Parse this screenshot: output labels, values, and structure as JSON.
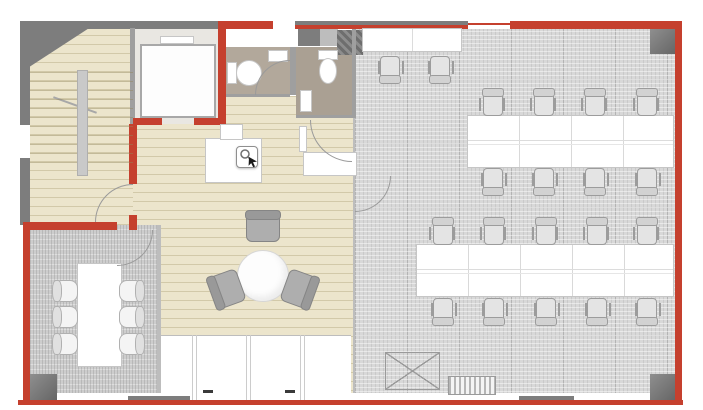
{
  "meta": {
    "title": "office-floor-plan",
    "description": "architectural floor plan drawing, no visible text labels",
    "cursor_overlay": "zoom-magnifier-cursor"
  },
  "palette": {
    "boundary_red": "#c5402e",
    "structural_wall_gray": "#7d7d7d",
    "partition_gray": "#9f9f9f",
    "wood_floor": "#ece5cc",
    "carpet_gray": "#d8d8d8",
    "meeting_carpet": "#cdcdcd",
    "bathroom_floor": "#b2a89b",
    "furniture_white": "#ffffff",
    "chair_gray": "#e4e4e4",
    "armchair_gray": "#aeaeae"
  },
  "legend": {
    "rooms": [
      "stairwell",
      "elevator",
      "wc-1",
      "wc-2",
      "entrance-hall",
      "kitchenette",
      "lounge",
      "meeting-room",
      "open-office",
      "vestibule"
    ],
    "counts": {
      "open_office_chairs": 20,
      "bench_desk_rows": 2,
      "wall_desks": 2,
      "meeting_room_chairs": 6,
      "lounge_armchairs": 3,
      "toilets": 2,
      "sinks": 2
    }
  },
  "stairs": {
    "x": 30,
    "y": 72,
    "w": 103,
    "count": 11,
    "step": 9
  },
  "vestibule_mullions": [
    192,
    196,
    246,
    250,
    300,
    304
  ],
  "door_markers": [
    {
      "x": 203,
      "y": 390
    },
    {
      "x": 285,
      "y": 390
    }
  ],
  "elements": [
    {
      "n": "stair-hall-floor",
      "c": "wood",
      "x": 30,
      "y": 28,
      "w": 103,
      "h": 197
    },
    {
      "n": "elevator-lobby-floor",
      "c": "lobbyf",
      "x": 133,
      "y": 28,
      "w": 85,
      "h": 96
    },
    {
      "n": "hall-floor-upper",
      "c": "wood",
      "x": 222,
      "y": 96,
      "w": 133,
      "h": 28
    },
    {
      "n": "hall-floor-main",
      "c": "wood",
      "x": 133,
      "y": 124,
      "w": 222,
      "h": 276
    },
    {
      "n": "office-floor",
      "c": "carpet",
      "x": 355,
      "y": 21,
      "w": 321,
      "h": 379
    },
    {
      "n": "meeting-room-floor",
      "c": "carpet2",
      "x": 30,
      "y": 225,
      "w": 131,
      "h": 175
    },
    {
      "n": "bath-1-floor",
      "c": "bathf",
      "x": 226,
      "y": 47,
      "w": 64,
      "h": 49
    },
    {
      "n": "bath-2-floor",
      "c": "bathf2",
      "x": 296,
      "y": 47,
      "w": 58,
      "h": 71
    },
    {
      "n": "vestibule-floor",
      "c": "window",
      "x": 161,
      "y": 335,
      "w": 190,
      "h": 65
    },
    {
      "n": "vestibule-top-line",
      "c": "thinline",
      "x": 161,
      "y": 335,
      "w": 190,
      "h": 1
    },
    {
      "n": "stair-stringer",
      "c": "stringer",
      "x": 77,
      "y": 70,
      "w": 11,
      "h": 106
    },
    {
      "n": "stair-direction-line",
      "c": "thinline2",
      "x": 52,
      "y": 104,
      "w": 46,
      "h": 2,
      "r": 20
    },
    {
      "n": "top-wall-left",
      "c": "wall",
      "x": 20,
      "y": 21,
      "w": 198,
      "h": 8
    },
    {
      "n": "top-left-chamfer-wall",
      "c": "tri",
      "x": 20,
      "y": 21,
      "w": 80,
      "h": 52
    },
    {
      "n": "left-wall-upper",
      "c": "wall",
      "x": 20,
      "y": 21,
      "w": 10,
      "h": 204
    },
    {
      "n": "left-wall-window",
      "c": "window",
      "x": 20,
      "y": 125,
      "w": 10,
      "h": 33
    },
    {
      "n": "top-wall-mid-gray",
      "c": "wall",
      "x": 295,
      "y": 21,
      "w": 173,
      "h": 5
    },
    {
      "n": "shaft-block",
      "c": "wall",
      "x": 298,
      "y": 27,
      "w": 22,
      "h": 19
    },
    {
      "n": "shaft-block-light",
      "c": "ltpart",
      "x": 320,
      "y": 29,
      "w": 18,
      "h": 17
    },
    {
      "n": "hatched-column",
      "c": "hatchcol",
      "x": 337,
      "y": 30,
      "w": 26,
      "h": 25
    },
    {
      "n": "corner-column-tr",
      "c": "wallD",
      "x": 650,
      "y": 29,
      "w": 26,
      "h": 25
    },
    {
      "n": "corner-column-br",
      "c": "wallD",
      "x": 650,
      "y": 374,
      "w": 26,
      "h": 26
    },
    {
      "n": "corner-column-bl",
      "c": "wallD",
      "x": 30,
      "y": 374,
      "w": 27,
      "h": 26
    },
    {
      "n": "stair-lobby-wall",
      "c": "partition",
      "x": 130,
      "y": 28,
      "w": 5,
      "h": 96
    },
    {
      "n": "bath-divider-wall",
      "c": "partition",
      "x": 290,
      "y": 47,
      "w": 6,
      "h": 48
    },
    {
      "n": "bath-1-bottom-wall",
      "c": "partition",
      "x": 222,
      "y": 94,
      "w": 68,
      "h": 3
    },
    {
      "n": "bath-2-bottom-wall",
      "c": "partition",
      "x": 296,
      "y": 115,
      "w": 58,
      "h": 3
    },
    {
      "n": "bath-office-wall",
      "c": "partition",
      "x": 352,
      "y": 28,
      "w": 4,
      "h": 90
    },
    {
      "n": "hall-office-boundary",
      "c": "thinline",
      "x": 353,
      "y": 118,
      "w": 2,
      "h": 282
    },
    {
      "n": "meeting-room-right-wall",
      "c": "ltpart",
      "x": 157,
      "y": 225,
      "w": 4,
      "h": 175
    },
    {
      "n": "top-wall-red-a",
      "c": "red",
      "x": 218,
      "y": 21,
      "w": 55,
      "h": 8
    },
    {
      "n": "top-window-gap-a",
      "c": "window",
      "x": 273,
      "y": 21,
      "w": 22,
      "h": 8
    },
    {
      "n": "top-wall-red-b",
      "c": "red",
      "x": 295,
      "y": 25,
      "w": 173,
      "h": 4
    },
    {
      "n": "top-window-gap-b",
      "c": "window",
      "x": 468,
      "y": 21,
      "w": 42,
      "h": 8
    },
    {
      "n": "top-window-red-line",
      "c": "red",
      "x": 468,
      "y": 23,
      "w": 42,
      "h": 2
    },
    {
      "n": "top-wall-red-c",
      "c": "red",
      "x": 510,
      "y": 21,
      "w": 170,
      "h": 8
    },
    {
      "n": "right-wall-red",
      "c": "red",
      "x": 675,
      "y": 21,
      "w": 7,
      "h": 384
    },
    {
      "n": "elevator-right-wall-red",
      "c": "red",
      "x": 218,
      "y": 28,
      "w": 8,
      "h": 96
    },
    {
      "n": "elevator-door-wall-left",
      "c": "red",
      "x": 133,
      "y": 118,
      "w": 29,
      "h": 7
    },
    {
      "n": "elevator-door-wall-right",
      "c": "red",
      "x": 194,
      "y": 118,
      "w": 32,
      "h": 7
    },
    {
      "n": "stair-hall-wall-red",
      "c": "red",
      "x": 129,
      "y": 124,
      "w": 8,
      "h": 60
    },
    {
      "n": "stair-hall-wall-cap",
      "c": "red",
      "x": 129,
      "y": 215,
      "w": 8,
      "h": 15
    },
    {
      "n": "meeting-room-top-wall",
      "c": "red",
      "x": 23,
      "y": 222,
      "w": 94,
      "h": 8
    },
    {
      "n": "left-wall-lower-red",
      "c": "red",
      "x": 23,
      "y": 230,
      "w": 7,
      "h": 175
    },
    {
      "n": "bottom-window-band",
      "c": "window",
      "x": 57,
      "y": 393,
      "w": 593,
      "h": 7
    },
    {
      "n": "bottom-wall-gray-a",
      "c": "wall",
      "x": 128,
      "y": 396,
      "w": 62,
      "h": 7
    },
    {
      "n": "bottom-wall-gray-b",
      "c": "wall",
      "x": 519,
      "y": 396,
      "w": 55,
      "h": 7
    },
    {
      "n": "bottom-wall-red",
      "c": "red",
      "x": 18,
      "y": 400,
      "w": 665,
      "h": 5
    },
    {
      "n": "elevator-car",
      "c": "whitebox2",
      "x": 140,
      "y": 44,
      "w": 76,
      "h": 74
    },
    {
      "n": "elevator-door-track",
      "c": "whitebox",
      "x": 160,
      "y": 36,
      "w": 34,
      "h": 8
    },
    {
      "n": "toilet-1-tank",
      "c": "whitebox",
      "x": 227,
      "y": 62,
      "w": 10,
      "h": 22
    },
    {
      "n": "toilet-1-bowl",
      "c": "whitebox ellipse",
      "x": 236,
      "y": 60,
      "w": 26,
      "h": 26
    },
    {
      "n": "sink-1",
      "c": "whitebox",
      "x": 268,
      "y": 50,
      "w": 20,
      "h": 12
    },
    {
      "n": "toilet-2-tank",
      "c": "whitebox",
      "x": 318,
      "y": 50,
      "w": 20,
      "h": 10
    },
    {
      "n": "toilet-2-bowl",
      "c": "whitebox ellipse",
      "x": 319,
      "y": 58,
      "w": 18,
      "h": 26
    },
    {
      "n": "sink-2",
      "c": "whitebox",
      "x": 300,
      "y": 90,
      "w": 12,
      "h": 22
    },
    {
      "n": "hall-door-leaf",
      "c": "whitebox",
      "x": 299,
      "y": 126,
      "w": 8,
      "h": 26
    },
    {
      "n": "kitchen-counter",
      "c": "whitebox",
      "x": 205,
      "y": 138,
      "w": 57,
      "h": 45
    },
    {
      "n": "kitchen-counter-upper",
      "c": "whitebox",
      "x": 220,
      "y": 124,
      "w": 23,
      "h": 16
    },
    {
      "n": "storage-cabinet",
      "c": "whitebox",
      "x": 303,
      "y": 152,
      "w": 54,
      "h": 24
    },
    {
      "n": "conference-table",
      "c": "whitebox",
      "x": 77,
      "y": 263,
      "w": 45,
      "h": 104
    },
    {
      "n": "round-table",
      "c": "round-table",
      "x": 237,
      "y": 250,
      "w": 52,
      "h": 52
    },
    {
      "n": "wall-desk-pair",
      "c": "bench2",
      "x": 362,
      "y": 28,
      "w": 100,
      "h": 24
    },
    {
      "n": "bench-desk-upper",
      "c": "bench",
      "x": 467,
      "y": 115,
      "w": 207,
      "h": 53
    },
    {
      "n": "bench-desk-lower",
      "c": "bench",
      "x": 416,
      "y": 244,
      "w": 258,
      "h": 53
    },
    {
      "n": "office-chair",
      "c": "chair",
      "x": 380,
      "y": 56,
      "w": 20,
      "h": 26
    },
    {
      "n": "office-chair",
      "c": "chair",
      "x": 430,
      "y": 56,
      "w": 20,
      "h": 26
    },
    {
      "n": "office-chair",
      "c": "chair",
      "x": 483,
      "y": 90,
      "w": 20,
      "h": 26,
      "r": 180
    },
    {
      "n": "office-chair",
      "c": "chair",
      "x": 534,
      "y": 90,
      "w": 20,
      "h": 26,
      "r": 180
    },
    {
      "n": "office-chair",
      "c": "chair",
      "x": 585,
      "y": 90,
      "w": 20,
      "h": 26,
      "r": 180
    },
    {
      "n": "office-chair",
      "c": "chair",
      "x": 637,
      "y": 90,
      "w": 20,
      "h": 26,
      "r": 180
    },
    {
      "n": "office-chair",
      "c": "chair",
      "x": 483,
      "y": 168,
      "w": 20,
      "h": 26
    },
    {
      "n": "office-chair",
      "c": "chair",
      "x": 534,
      "y": 168,
      "w": 20,
      "h": 26
    },
    {
      "n": "office-chair",
      "c": "chair",
      "x": 585,
      "y": 168,
      "w": 20,
      "h": 26
    },
    {
      "n": "office-chair",
      "c": "chair",
      "x": 637,
      "y": 168,
      "w": 20,
      "h": 26
    },
    {
      "n": "office-chair",
      "c": "chair",
      "x": 433,
      "y": 219,
      "w": 20,
      "h": 26,
      "r": 180
    },
    {
      "n": "office-chair",
      "c": "chair",
      "x": 484,
      "y": 219,
      "w": 20,
      "h": 26,
      "r": 180
    },
    {
      "n": "office-chair",
      "c": "chair",
      "x": 536,
      "y": 219,
      "w": 20,
      "h": 26,
      "r": 180
    },
    {
      "n": "office-chair",
      "c": "chair",
      "x": 587,
      "y": 219,
      "w": 20,
      "h": 26,
      "r": 180
    },
    {
      "n": "office-chair",
      "c": "chair",
      "x": 637,
      "y": 219,
      "w": 20,
      "h": 26,
      "r": 180
    },
    {
      "n": "office-chair",
      "c": "chair",
      "x": 433,
      "y": 298,
      "w": 20,
      "h": 26
    },
    {
      "n": "office-chair",
      "c": "chair",
      "x": 484,
      "y": 298,
      "w": 20,
      "h": 26
    },
    {
      "n": "office-chair",
      "c": "chair",
      "x": 536,
      "y": 298,
      "w": 20,
      "h": 26
    },
    {
      "n": "office-chair",
      "c": "chair",
      "x": 587,
      "y": 298,
      "w": 20,
      "h": 26
    },
    {
      "n": "office-chair",
      "c": "chair",
      "x": 637,
      "y": 298,
      "w": 20,
      "h": 26
    },
    {
      "n": "conference-chair",
      "c": "confchair",
      "x": 55,
      "y": 279,
      "w": 22,
      "h": 24,
      "r": 90
    },
    {
      "n": "conference-chair",
      "c": "confchair",
      "x": 55,
      "y": 305,
      "w": 22,
      "h": 24,
      "r": 90
    },
    {
      "n": "conference-chair",
      "c": "confchair",
      "x": 55,
      "y": 332,
      "w": 22,
      "h": 24,
      "r": 90
    },
    {
      "n": "conference-chair",
      "c": "confchair",
      "x": 120,
      "y": 279,
      "w": 22,
      "h": 24,
      "r": -90
    },
    {
      "n": "conference-chair",
      "c": "confchair",
      "x": 120,
      "y": 305,
      "w": 22,
      "h": 24,
      "r": -90
    },
    {
      "n": "conference-chair",
      "c": "confchair",
      "x": 120,
      "y": 332,
      "w": 22,
      "h": 24,
      "r": -90
    },
    {
      "n": "lounge-armchair",
      "c": "armchair",
      "x": 246,
      "y": 212,
      "w": 34,
      "h": 30,
      "r": 180
    },
    {
      "n": "lounge-armchair",
      "c": "armchair",
      "x": 210,
      "y": 274,
      "w": 34,
      "h": 30,
      "r": 70
    },
    {
      "n": "lounge-armchair",
      "c": "armchair",
      "x": 282,
      "y": 274,
      "w": 34,
      "h": 30,
      "r": -70
    },
    {
      "n": "floor-opening-x",
      "c": "xbox",
      "x": 385,
      "y": 352,
      "w": 55,
      "h": 38
    },
    {
      "n": "floor-grille",
      "c": "hatchmat",
      "x": 448,
      "y": 376,
      "w": 48,
      "h": 19
    },
    {
      "n": "stair-door-swing",
      "c": "arc-tl",
      "x": 95,
      "y": 184,
      "w": 38,
      "h": 38
    },
    {
      "n": "meeting-door-swing",
      "c": "arc-br",
      "x": 117,
      "y": 230,
      "w": 36,
      "h": 36
    },
    {
      "n": "bath-1-door-swing",
      "c": "arc-tl",
      "x": 255,
      "y": 60,
      "w": 35,
      "h": 35
    },
    {
      "n": "bath-2-door-swing",
      "c": "arc-bl",
      "x": 310,
      "y": 120,
      "w": 42,
      "h": 42
    },
    {
      "n": "office-door-swing",
      "c": "arc-br",
      "x": 355,
      "y": 176,
      "w": 36,
      "h": 36
    }
  ]
}
